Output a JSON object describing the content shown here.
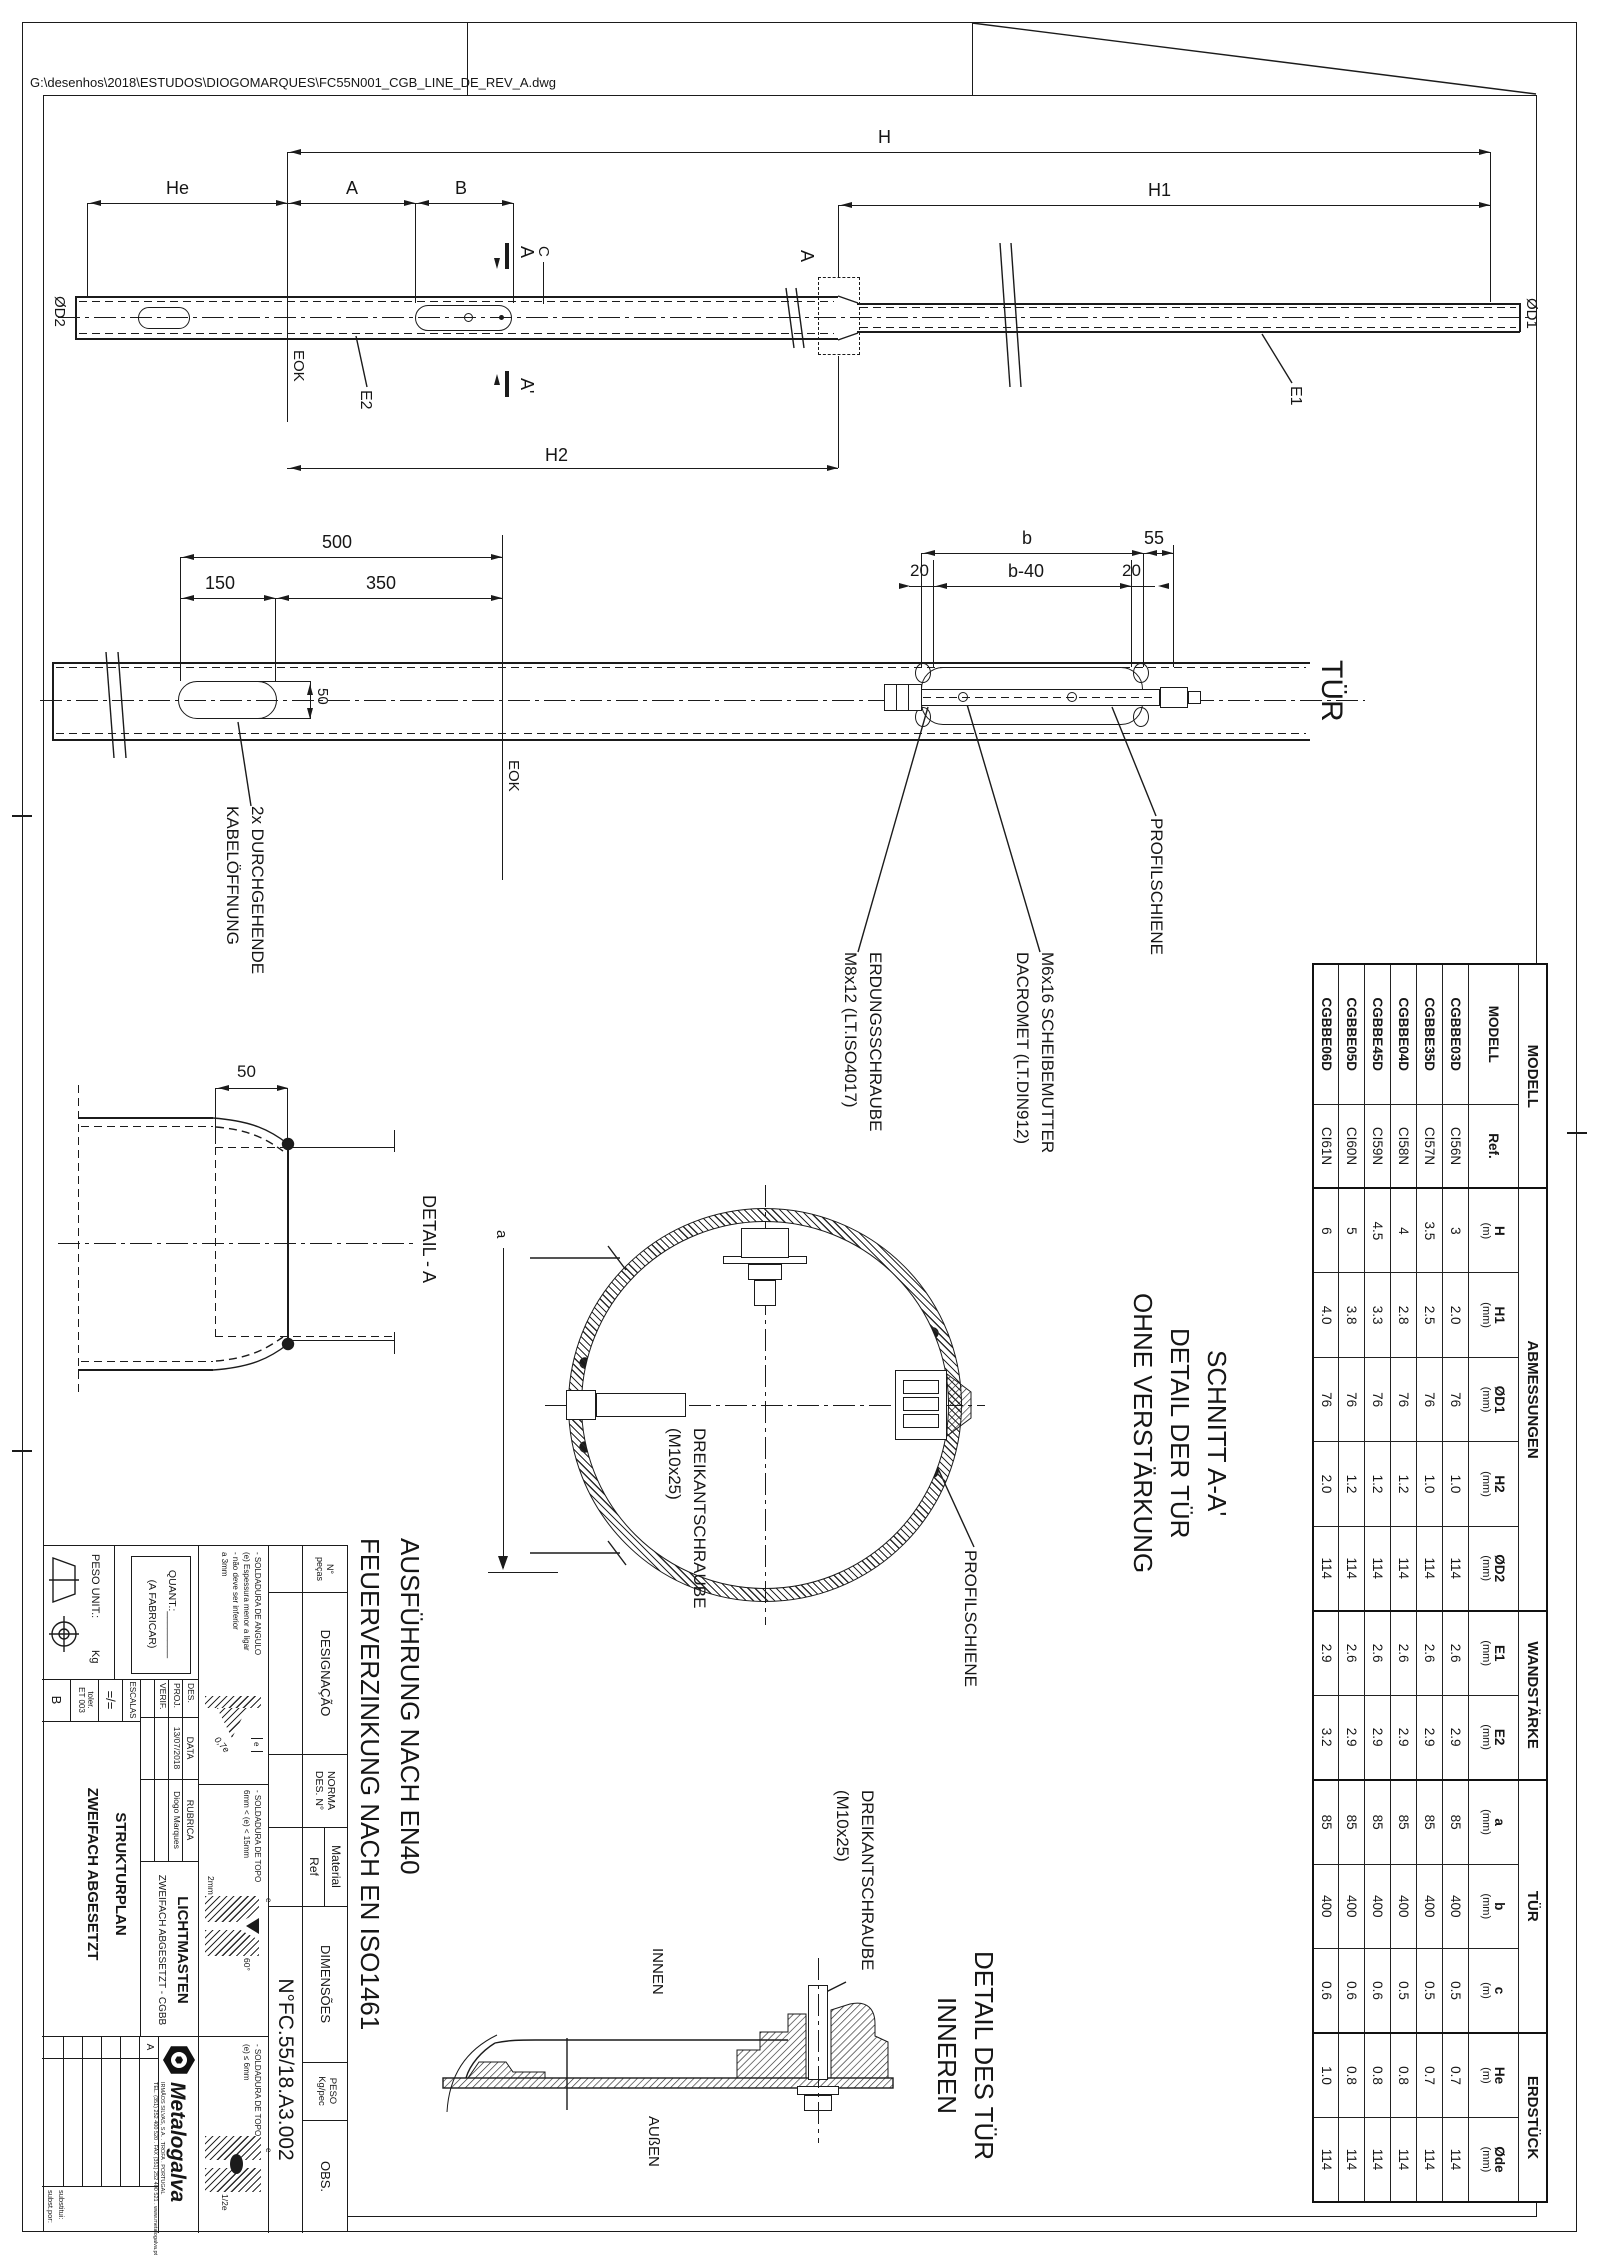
{
  "sheet": {
    "file_path": "G:\\desenhos\\2018\\ESTUDOS\\DIOGOMARQUES\\FC55N001_CGB_LINE_DE_REV_A.dwg"
  },
  "top_view": {
    "dim_h": "H",
    "dim_h1": "H1",
    "dim_h2": "H2",
    "dim_he": "He",
    "dim_a": "A",
    "dim_b": "B",
    "dim_c": "C",
    "eok": "EOK",
    "e1": "E1",
    "e2": "E2",
    "od1": "ØD1",
    "od2": "ØD2",
    "section_a": "A",
    "section_a_prime": "A'",
    "detail_callout": "A"
  },
  "door_view": {
    "dim_500": "500",
    "dim_150": "150",
    "dim_350": "350",
    "dim_50": "50",
    "dim_b": "b",
    "dim_55": "55",
    "dim_20": "20",
    "dim_b40": "b-40",
    "eok": "EOK",
    "tur": "TÜR",
    "kabel_l1": "2x DURCHGEHENDE",
    "kabel_l2": "KABELÖFFNUNG",
    "erdung_l1": "ERDUNGSSCHRAUBE",
    "erdung_l2": "M8x12 (LT.ISO4017)",
    "mutter_l1": "M6x16 SCHEIBEMUTTER",
    "mutter_l2": "DACROMET (LT.DIN912)",
    "profilschiene": "PROFILSCHIENE"
  },
  "detail_a": {
    "dim_50": "50",
    "title": "DETAIL - A"
  },
  "section_view": {
    "title_l1": "SCHNITT A-A'",
    "title_l2": "DETAIL DER TÜR",
    "title_l3": "OHNE VERSTÄRKUNG",
    "schraube_l1": "DREIKANTSCHRAUBE",
    "schraube_l2": "(M10x25)",
    "profilschiene": "PROFILSCHIENE",
    "dim_a": "a"
  },
  "notes": {
    "line1": "AUSFÜHRUNG NACH EN40",
    "line2": "FEUERVERZINKUNG NACH EN ISO1461"
  },
  "inner_detail": {
    "title_l1": "DETAIL DES TÜR",
    "title_l2": "INNEREN",
    "schraube_l1": "DREIKANTSCHRAUBE",
    "schraube_l2": "(M10x25)",
    "innen": "INNEN",
    "aussen": "AUßEN"
  },
  "table": {
    "groups": [
      {
        "label": "MODELL"
      },
      {
        "label": "ABMESSUNGEN"
      },
      {
        "label": "WANDSTÄRKE"
      },
      {
        "label": "TÜR"
      },
      {
        "label": "ERDSTÜCK"
      }
    ],
    "cols": [
      {
        "l": "MODELL",
        "u": ""
      },
      {
        "l": "Ref.",
        "u": ""
      },
      {
        "l": "H",
        "u": "(m)"
      },
      {
        "l": "H1",
        "u": "(mm)"
      },
      {
        "l": "ØD1",
        "u": "(mm)"
      },
      {
        "l": "H2",
        "u": "(mm)"
      },
      {
        "l": "ØD2",
        "u": "(mm)"
      },
      {
        "l": "E1",
        "u": "(mm)"
      },
      {
        "l": "E2",
        "u": "(mm)"
      },
      {
        "l": "a",
        "u": "(mm)"
      },
      {
        "l": "b",
        "u": "(mm)"
      },
      {
        "l": "c",
        "u": "(m)"
      },
      {
        "l": "He",
        "u": "(m)"
      },
      {
        "l": "Øde",
        "u": "(mm)"
      }
    ],
    "rows": [
      [
        "CGBBE03D",
        "CI56N",
        "3",
        "2.0",
        "76",
        "1.0",
        "114",
        "2.6",
        "2.9",
        "85",
        "400",
        "0.5",
        "0.7",
        "114"
      ],
      [
        "CGBBE35D",
        "CI57N",
        "3.5",
        "2.5",
        "76",
        "1.0",
        "114",
        "2.6",
        "2.9",
        "85",
        "400",
        "0.5",
        "0.7",
        "114"
      ],
      [
        "CGBBE04D",
        "CI58N",
        "4",
        "2.8",
        "76",
        "1.2",
        "114",
        "2.6",
        "2.9",
        "85",
        "400",
        "0.5",
        "0.8",
        "114"
      ],
      [
        "CGBBE45D",
        "CI59N",
        "4.5",
        "3.3",
        "76",
        "1.2",
        "114",
        "2.6",
        "2.9",
        "85",
        "400",
        "0.6",
        "0.8",
        "114"
      ],
      [
        "CGBBE05D",
        "CI60N",
        "5",
        "3.8",
        "76",
        "1.2",
        "114",
        "2.6",
        "2.9",
        "85",
        "400",
        "0.6",
        "0.8",
        "114"
      ],
      [
        "CGBBE06D",
        "CI61N",
        "6",
        "4.0",
        "76",
        "2.0",
        "114",
        "2.9",
        "3.2",
        "85",
        "400",
        "0.6",
        "1.0",
        "114"
      ]
    ]
  },
  "title_block": {
    "col_pecas_l1": "N°",
    "col_pecas_l2": "peças",
    "col_designacao": "DESIGNAÇÃO",
    "col_norma": "NORMA",
    "col_des_n": "DES. N°",
    "col_material": "Material",
    "col_ref": "Ref",
    "col_dimensoes": "DIMENSÕES",
    "col_peso": "PESO",
    "col_peso_u": "Kg/pec",
    "col_obs": "OBS.",
    "drawing_no": "N°FC.55/18.A3.002",
    "weld1_l1": "- SOLDADURA DE ANGULO",
    "weld1_l2": "(e) Espessura menor a ligar",
    "weld1_l3": "- não deve ser inferior",
    "weld1_l4": "a 3mm",
    "weld1_val": "0,7e",
    "weld1_e": "e",
    "weld2_l1": "- SOLDADURA DE TOPO",
    "weld2_l2": "6mm < (e) < 15mm",
    "weld2_angle": "60°",
    "weld2_gap": "2mm",
    "weld2_e": "e",
    "weld3_l1": "- SOLDADURA DE TOPO",
    "weld3_l2": "(e) ≤ 6mm",
    "weld3_val": "1/2e",
    "weld3_e": "e",
    "quant_l1": "QUANT.:________",
    "quant_l2": "(A FABRICAR)",
    "peso_unit": "PESO UNIT.:",
    "peso_kg": "Kg",
    "escalas": "ESCALAS",
    "escala_val": "=/=",
    "toler": "toler.",
    "et": "ET 003",
    "rev_letter": "B",
    "des": "DES.",
    "proj": "PROJ.",
    "verif": "VERIF.",
    "data": "DATA",
    "rubrica": "RUBRICA",
    "date": "13/07/2018",
    "author": "Diogo Marques",
    "product": "LICHTMASTEN",
    "product_sub": "ZWEIFACH ABGESETZT - CGBB",
    "title_l1": "STRUKTURPLAN",
    "title_l2": "ZWEIFACH ABGESETZT",
    "brand": "Metalogalva",
    "brand_addr1": "IRMÃOS SILVAS, S.A. . TROFA . PORTUGAL",
    "brand_addr2": "TEL. (351) 252 400 520 . FAX (351) 252 400 521 . www.metalogalva.pt",
    "rev_a": "A",
    "substitui": "substitui:",
    "subst_por": "subst.por:"
  }
}
